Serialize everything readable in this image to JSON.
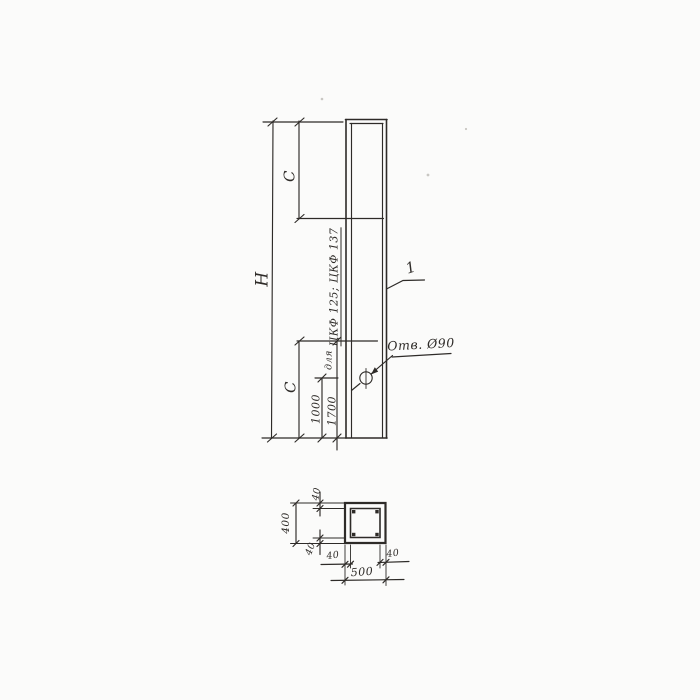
{
  "elevation": {
    "height_label": "H",
    "c_top_label": "C",
    "c_bottom_label": "C",
    "dim_1000": "1000",
    "dim_1700": "1700",
    "note_prefix": "для",
    "note_marks": "ЦКФ 125; ЦКФ 137",
    "hole_note": "Отв. Ø90",
    "item_number": "1"
  },
  "section": {
    "overall_width": "500",
    "overall_height": "400",
    "wall_top": "40",
    "wall_bottom": "40",
    "wall_left": "40",
    "wall_right": "40"
  },
  "colors": {
    "ink": "#2e2b28",
    "paper": "#fbfbfa"
  }
}
